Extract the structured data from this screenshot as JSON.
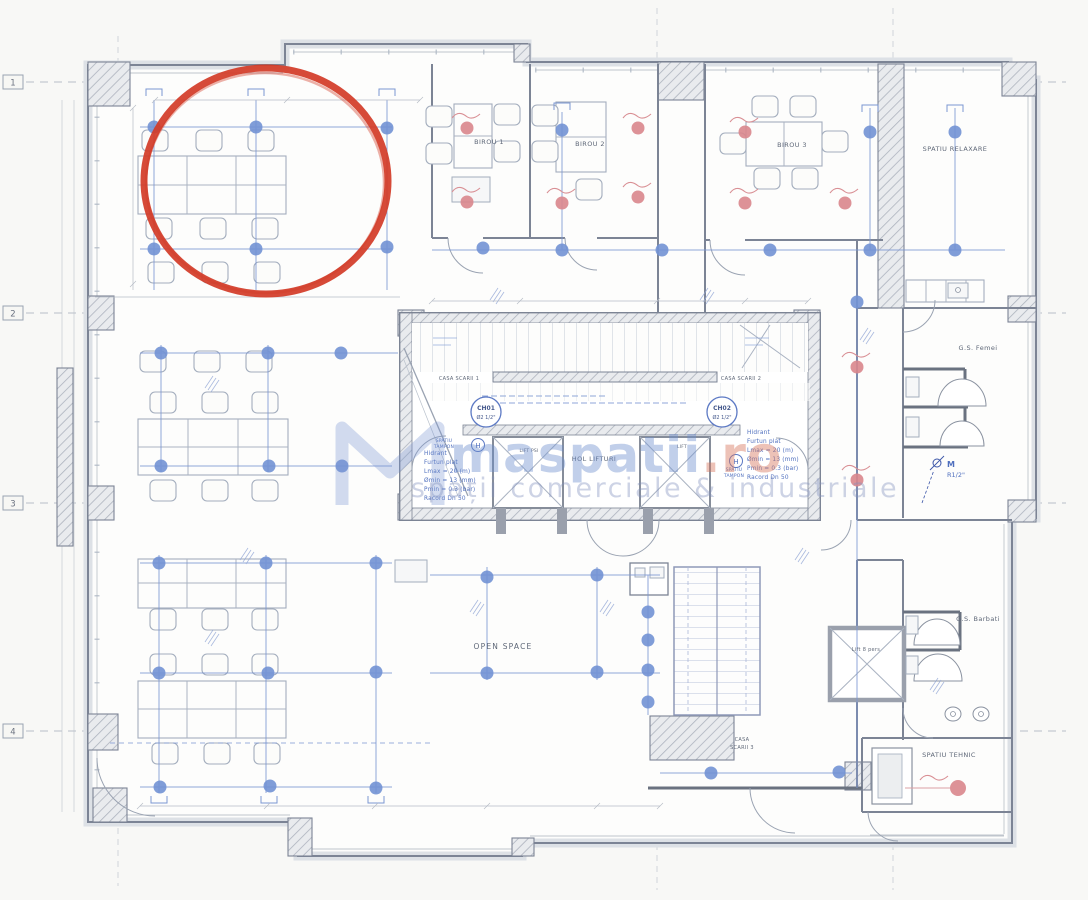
{
  "colors": {
    "paper": "#f8f8f6",
    "wall": "#7c8495",
    "furniture_line": "#a3adbd",
    "pipe_blue": "#7b96d2",
    "sprinkler_blue": "#7292d4",
    "sprinkler_red": "#d9868c",
    "annotation_red": "#d23b27",
    "label_text": "#5f6878",
    "blue_text": "#4f6fbe",
    "watermark_blue": "#6c8ccd",
    "watermark_orange": "#d6785f"
  },
  "grid": {
    "rows": [
      "1",
      "2",
      "3",
      "4"
    ]
  },
  "rooms": {
    "birou1": "BIROU 1",
    "birou2": "BIROU 2",
    "birou3": "BIROU 3",
    "spatiu_relaxare": "SPATIU RELAXARE",
    "casa_scarii_1": "CASA SCARII 1",
    "casa_scarii_2": "CASA SCARII 2",
    "casa_scarii_3_line1": "CASA",
    "casa_scarii_3_line2": "SCARII 3",
    "hol_lifturi": "HOL LIFTURI",
    "lift_psi": "LIFT PSI",
    "lift": "LIFT",
    "lift_8_pers": "Lift 8 pers",
    "spatiu_tampon_line1": "SPATIU",
    "spatiu_tampon_line2": "TAMPON",
    "gs_femei": "G.S. Femei",
    "gs_barbati": "G.S. Barbati",
    "open_space": "OPEN SPACE",
    "spatiu_tehnic": "SPATIU TEHNIC"
  },
  "hydrants": {
    "ch01_id": "CH01",
    "ch01_size": "Ø2 1/2\"",
    "ch02_id": "CH02",
    "ch02_size": "Ø2 1/2\"",
    "symbol": "H",
    "note": [
      "Hidrant",
      "Furtun plat",
      "Lmax = 20 (m)",
      "Ømin = 13 (mm)",
      "Pmin = 0.3 (bar)",
      "Racord Dn 50"
    ]
  },
  "plumbing": {
    "valve_label_line1": "M",
    "valve_label_line2": "R1/2\""
  },
  "watermark": {
    "brand_main": "maspatii",
    "brand_tld": ".ro",
    "tagline": "spații comerciale & industriale"
  }
}
